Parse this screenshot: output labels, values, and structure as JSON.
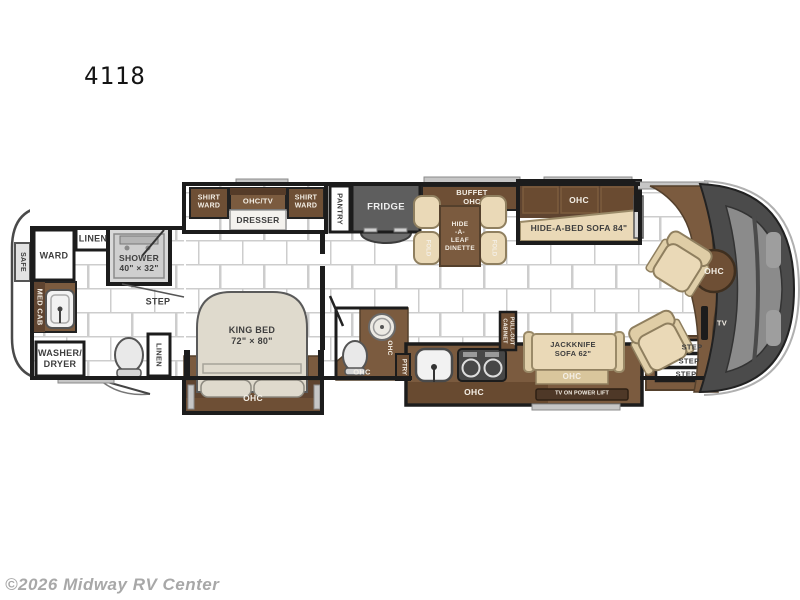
{
  "title": "4118",
  "watermark": "©2026 Midway RV Center",
  "rear_bath": {
    "safe": "SAFE",
    "ward": "WARD",
    "linen": "LINEN",
    "shower": "SHOWER\n40\" × 32\"",
    "med_cab": "MED CAB",
    "step": "STEP",
    "washer_dryer": "WASHER/\nDRYER",
    "linen_hall": "LINEN"
  },
  "bedroom": {
    "shirt_ward_left": "SHIRT\nWARD",
    "ohc_tv": "OHC/TV",
    "dresser": "DRESSER",
    "shirt_ward_right": "SHIRT\nWARD",
    "king_bed": "KING BED\n72\" × 80\"",
    "ohc": "OHC"
  },
  "mid_bath": {
    "ohc_side": "OHC",
    "ohc": "OHC",
    "ptry": "PTRY"
  },
  "kitchen": {
    "pantry": "PANTRY",
    "fridge": "FRIDGE",
    "pull_out_cabinet": "PULL-OUT\nCABINET",
    "ohc": "OHC"
  },
  "dinette": {
    "buffet_ohc": "BUFFET\nOHC",
    "table": "HIDE\n-A-\nLEAF\nDINETTE",
    "fold_left": "FOLD",
    "fold_right": "FOLD"
  },
  "living": {
    "sofa_ohc": "OHC",
    "hide_a_bed_sofa": "HIDE-A-BED SOFA 84\"",
    "jackknife_sofa": "JACKKNIFE\nSOFA 62\"",
    "jackknife_ohc": "OHC",
    "tv_power_lift": "TV ON POWER LIFT"
  },
  "entry": {
    "step_1": "STEP",
    "step_2": "STEP",
    "step_3": "STEP"
  },
  "cockpit": {
    "ohc": "OHC",
    "tv": "TV"
  },
  "colors": {
    "cabinet_brown": "#7b5b3f",
    "cabinet_dark": "#5f4430",
    "upholstery_tan": "#ead9b7",
    "bed_beige": "#dfdacd",
    "appliance_gray": "#5e5e5e",
    "front_cap_gray": "#4b4b4b",
    "wall_black": "#1c1c1c",
    "tile_line": "#cdcdcd",
    "watermark_gray": "#a8a8a8"
  }
}
